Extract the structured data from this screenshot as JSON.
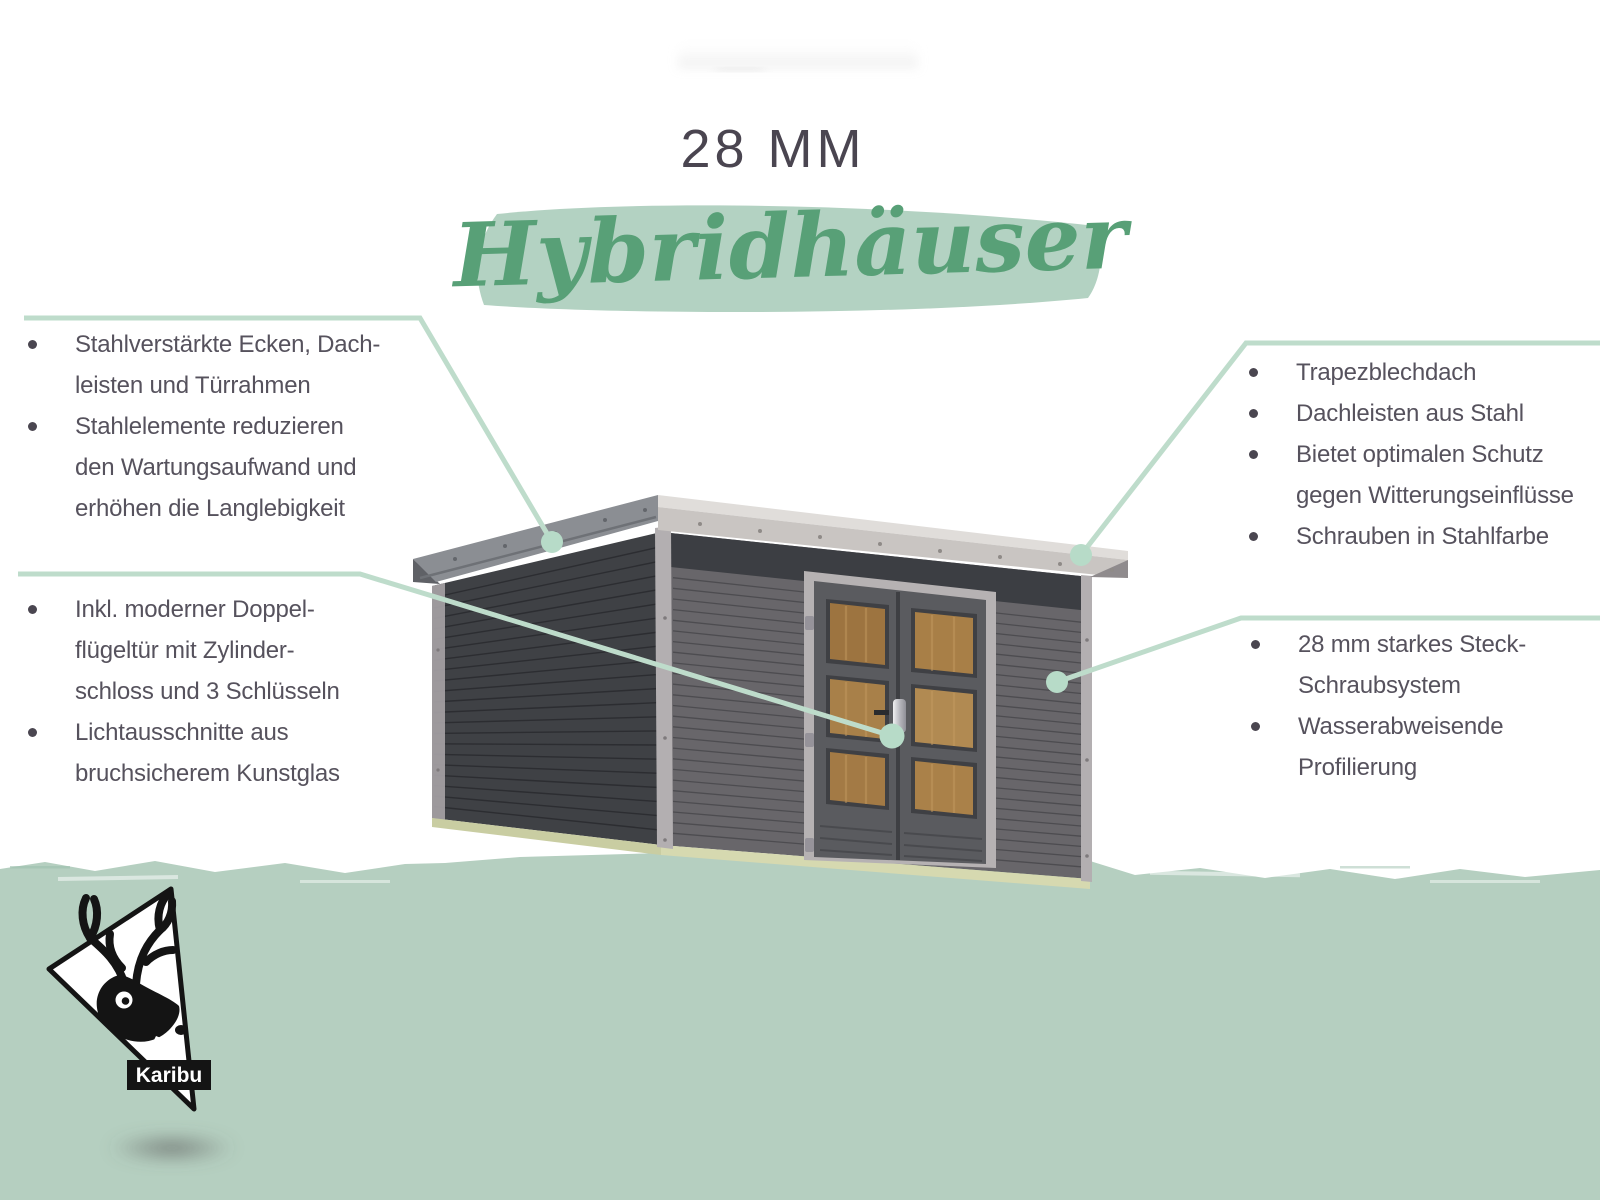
{
  "title": "28 MM",
  "subtitle": "Hybridhäuser",
  "brand": {
    "logo_text": "Karibu"
  },
  "theme": {
    "accent_line_green": "#bedccb",
    "accent_dot_green": "#b7dbc8",
    "highlight_band_green": "#a8ccb9",
    "script_green": "#58a077",
    "ground_green": "#b5cfc0",
    "text_gray": "#56525d",
    "title_gray": "#4a4550",
    "shed_left_wall": "#3f4145",
    "shed_front_wall": "#68666a",
    "roof_light": "#dfdcd9",
    "door_wood": "#a37a45"
  },
  "callouts": {
    "top_left": {
      "items": [
        {
          "lines": [
            "Stahlverstärkte Ecken, Dach-",
            "leisten und Türrahmen"
          ]
        },
        {
          "lines": [
            "Stahlelemente reduzieren",
            "den Wartungsaufwand und",
            "erhöhen die Langlebigkeit"
          ]
        }
      ]
    },
    "bottom_left": {
      "items": [
        {
          "lines": [
            "Inkl. moderner Doppel-",
            "flügeltür mit Zylinder-",
            "schloss und 3 Schlüsseln"
          ]
        },
        {
          "lines": [
            "Lichtausschnitte aus",
            "bruchsicherem Kunstglas"
          ]
        }
      ]
    },
    "top_right": {
      "items": [
        {
          "lines": [
            "Trapezblechdach"
          ]
        },
        {
          "lines": [
            "Dachleisten aus Stahl"
          ]
        },
        {
          "lines": [
            "Bietet optimalen Schutz",
            "gegen Witterungseinflüsse"
          ]
        },
        {
          "lines": [
            "Schrauben in Stahlfarbe"
          ]
        }
      ]
    },
    "bottom_right": {
      "items": [
        {
          "lines": [
            "28 mm starkes Steck-",
            "Schraubsystem"
          ]
        },
        {
          "lines": [
            "Wasserabweisende",
            "Profilierung"
          ]
        }
      ]
    }
  }
}
